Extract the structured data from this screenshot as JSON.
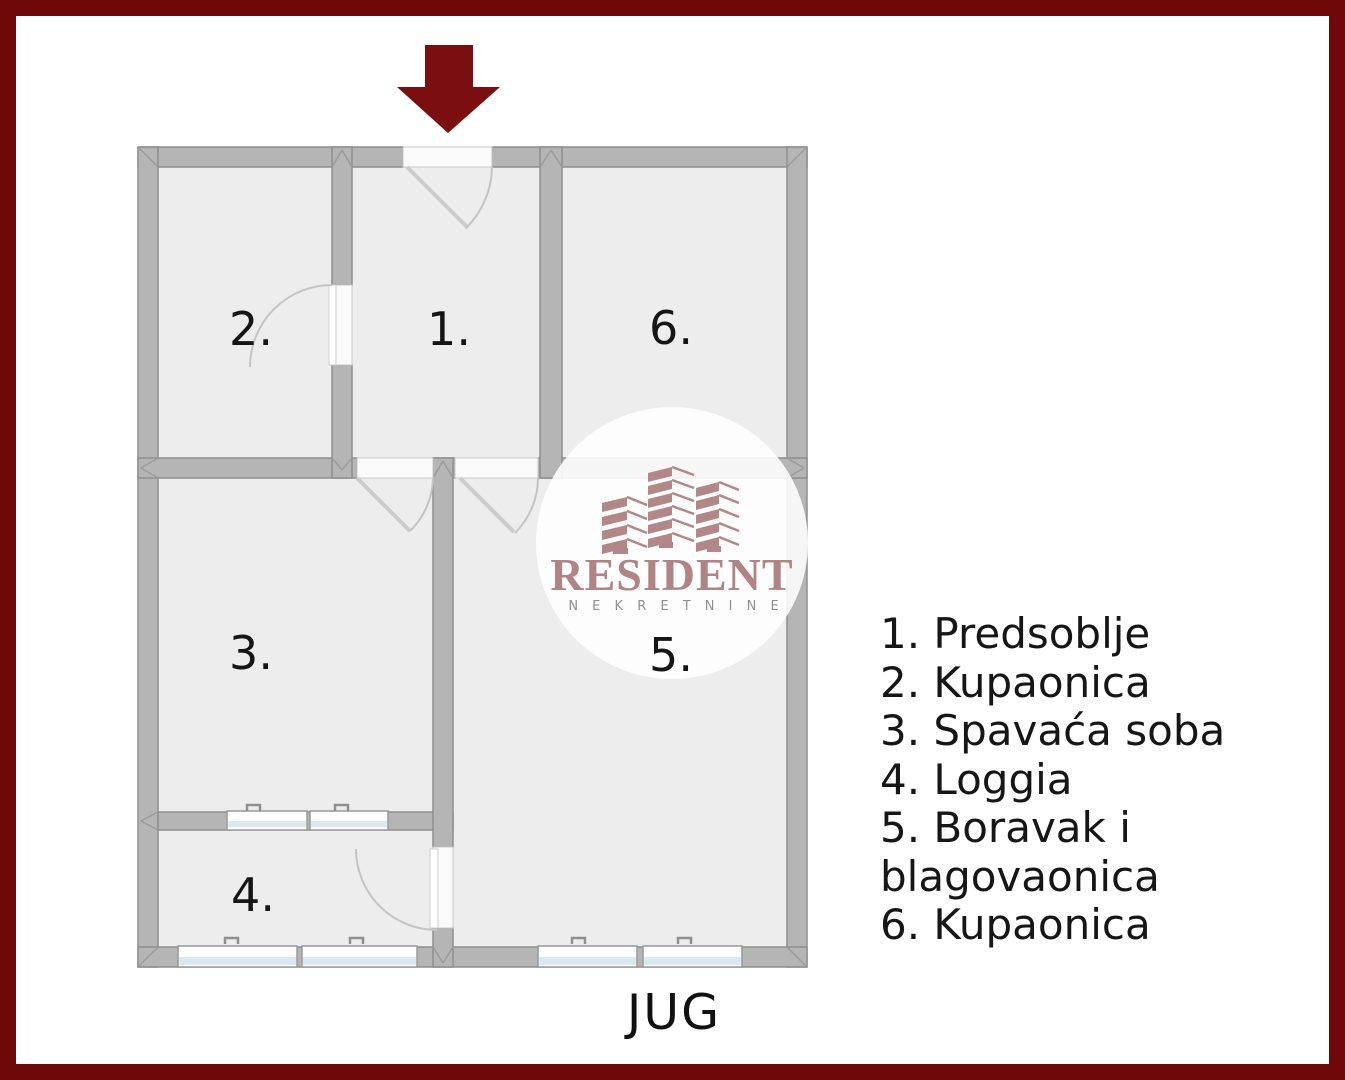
{
  "compass": {
    "label": "JUG"
  },
  "legend": {
    "items": [
      "1. Predsoblje",
      "2. Kupaonica",
      "3. Spavaća soba",
      "4. Loggia",
      "5. Boravak i blagovaonica",
      "6. Kupaonica"
    ]
  },
  "rooms": [
    {
      "label": "1."
    },
    {
      "label": "2."
    },
    {
      "label": "3."
    },
    {
      "label": "4."
    },
    {
      "label": "5."
    },
    {
      "label": "6."
    }
  ],
  "watermark": {
    "brand": "RESIDENT",
    "tagline": "N E K R E T N I N E"
  },
  "colors": {
    "border_red": "#6f0909",
    "arrow_red": "#7b0f0f",
    "wall_fill": "#b5b5b5",
    "wall_stroke": "#8f8f8f",
    "floor_gray": "#ededed",
    "window_blue": "#d9e9ef",
    "logo_rose": "#b28787",
    "tagline_gray": "#8f9094",
    "text_black": "#161616"
  }
}
